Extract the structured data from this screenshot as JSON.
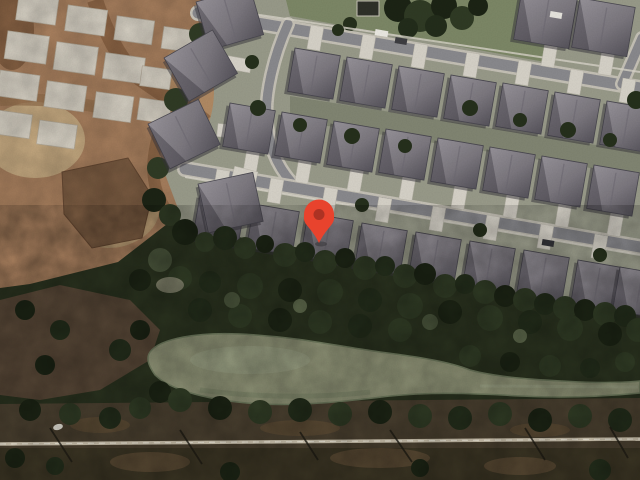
{
  "map": {
    "view": "satellite",
    "marker": {
      "name": "location-marker",
      "x": 319,
      "y": 243,
      "transform": "translate(319,243)",
      "color": "#E8432D",
      "dot_color": "#AD3223"
    },
    "palette": {
      "forest": "#2A321F",
      "lawn": "#999B8A",
      "grass_strip": "#7D8867",
      "asphalt": "#8A8A8E",
      "curb": "#C6C2B7",
      "roof_light": "#908C93",
      "roof_dark": "#5A575D",
      "driveway": "#D7D3C9",
      "dirt": "#AB8260",
      "slab": "#D9D3C6",
      "mud_pond": "#7B5C42",
      "pond": "#8D9175",
      "marsh": "#564636",
      "scrub": "#4A4030",
      "track": "#D3C9B4"
    },
    "features": [
      "construction-site",
      "residential-neighborhood",
      "forest",
      "pond",
      "marsh",
      "railway-track",
      "scrub-strip"
    ]
  }
}
